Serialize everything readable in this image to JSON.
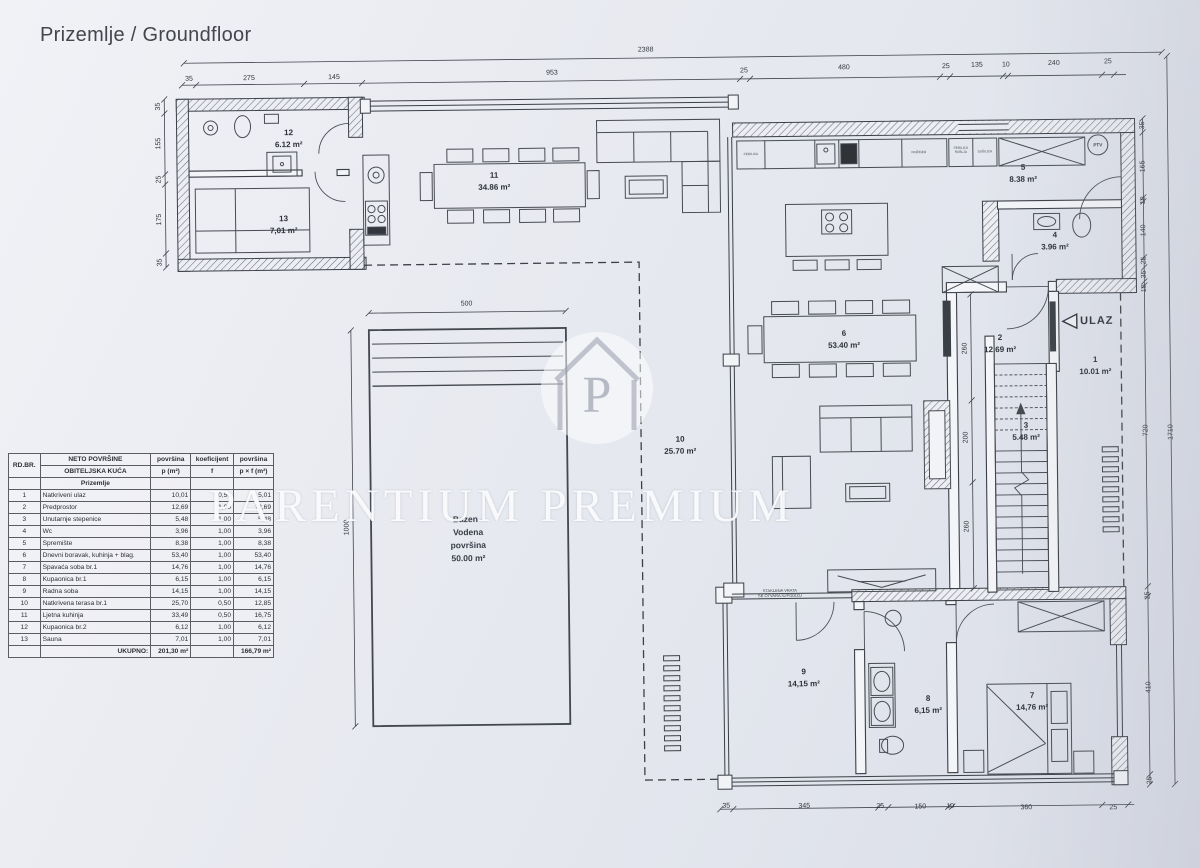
{
  "title": "Prizemlje / Groundfloor",
  "colors": {
    "paper": "#e7e9ef",
    "line": "#3b3f46",
    "watermark": "#ffffff"
  },
  "watermark": {
    "text": "PARENTIUM PREMIUM",
    "monogram": "P"
  },
  "table": {
    "corner": "RD.BR.",
    "h1": "NETO POVRŠINE",
    "h2": "OBITELJSKA KUĆA",
    "c1a": "površina",
    "c1b": "p (m²)",
    "c2a": "koeficijent",
    "c2b": "f",
    "c3a": "površina",
    "c3b": "p × f (m²)",
    "section": "Prizemlje",
    "rows": [
      [
        "1",
        "Natkriveni ulaz",
        "10,01",
        "0,50",
        "5,01"
      ],
      [
        "2",
        "Predprostor",
        "12,69",
        "1,00",
        "12,69"
      ],
      [
        "3",
        "Unutarnje stepenice",
        "5,48",
        "1,00",
        "5,48"
      ],
      [
        "4",
        "Wc",
        "3,96",
        "1,00",
        "3,96"
      ],
      [
        "5",
        "Spremište",
        "8,38",
        "1,00",
        "8,38"
      ],
      [
        "6",
        "Dnevni boravak, kuhinja + blag.",
        "53,40",
        "1,00",
        "53,40"
      ],
      [
        "7",
        "Spavaća soba br.1",
        "14,76",
        "1,00",
        "14,76"
      ],
      [
        "8",
        "Kupaonica br.1",
        "6,15",
        "1,00",
        "6,15"
      ],
      [
        "9",
        "Radna soba",
        "14,15",
        "1,00",
        "14,15"
      ],
      [
        "10",
        "Natkrivena terasa br.1",
        "25,70",
        "0,50",
        "12,85"
      ],
      [
        "11",
        "Ljetna kuhinja",
        "33,49",
        "0,50",
        "16,75"
      ],
      [
        "12",
        "Kupaonica br.2",
        "6,12",
        "1,00",
        "6,12"
      ],
      [
        "13",
        "Sauna",
        "7,01",
        "1,00",
        "7,01"
      ]
    ],
    "total_label": "UKUPNO:",
    "total_p": "201,30 m²",
    "total_pf": "166,79 m²"
  },
  "plan": {
    "rooms": [
      {
        "t": "12\n6.12 m²",
        "x": 292,
        "y": 135
      },
      {
        "t": "13\n7,01 m²",
        "x": 286,
        "y": 221
      },
      {
        "t": "11\n34.86 m²",
        "x": 497,
        "y": 180
      },
      {
        "t": "5\n8.38 m²",
        "x": 1026,
        "y": 178
      },
      {
        "t": "4\n3.96 m²",
        "x": 1057,
        "y": 246
      },
      {
        "t": "6\n53.40 m²",
        "x": 845,
        "y": 342
      },
      {
        "t": "2\n12.69 m²",
        "x": 1001,
        "y": 348
      },
      {
        "t": "1\n10.01 m²",
        "x": 1096,
        "y": 371
      },
      {
        "t": "3\n5.48 m²",
        "x": 1026,
        "y": 436
      },
      {
        "t": "10\n25.70 m²",
        "x": 680,
        "y": 446
      },
      {
        "t": "9\n14,15 m²",
        "x": 801,
        "y": 680
      },
      {
        "t": "8\n6,15 m²",
        "x": 925,
        "y": 708
      },
      {
        "t": "7\n14,76 m²",
        "x": 1029,
        "y": 706
      }
    ],
    "dims": [
      {
        "t": "2388",
        "x": 650,
        "y": 50
      },
      {
        "t": "35",
        "x": 193,
        "y": 74
      },
      {
        "t": "275",
        "x": 253,
        "y": 74
      },
      {
        "t": "145",
        "x": 338,
        "y": 74
      },
      {
        "t": "953",
        "x": 556,
        "y": 72
      },
      {
        "t": "25",
        "x": 748,
        "y": 72
      },
      {
        "t": "480",
        "x": 848,
        "y": 70
      },
      {
        "t": "25",
        "x": 950,
        "y": 70
      },
      {
        "t": "135",
        "x": 981,
        "y": 69
      },
      {
        "t": "10",
        "x": 1010,
        "y": 69
      },
      {
        "t": "240",
        "x": 1058,
        "y": 68
      },
      {
        "t": "25",
        "x": 1112,
        "y": 67
      },
      {
        "t": "35",
        "x": 162,
        "y": 101,
        "r": 1
      },
      {
        "t": "155",
        "x": 162,
        "y": 138,
        "r": 1
      },
      {
        "t": "25",
        "x": 162,
        "y": 174,
        "r": 1
      },
      {
        "t": "175",
        "x": 162,
        "y": 214,
        "r": 1
      },
      {
        "t": "35",
        "x": 162,
        "y": 257,
        "r": 1
      },
      {
        "t": "35",
        "x": 1146,
        "y": 131,
        "r": 1
      },
      {
        "t": "165",
        "x": 1146,
        "y": 172,
        "r": 1
      },
      {
        "t": "10",
        "x": 1146,
        "y": 206,
        "r": 1
      },
      {
        "t": "140",
        "x": 1146,
        "y": 236,
        "r": 1
      },
      {
        "t": "25",
        "x": 1146,
        "y": 266,
        "r": 1
      },
      {
        "t": "35",
        "x": 1146,
        "y": 280,
        "r": 1
      },
      {
        "t": "10",
        "x": 1146,
        "y": 294,
        "r": 1
      },
      {
        "t": "720",
        "x": 1146,
        "y": 436,
        "r": 1
      },
      {
        "t": "25",
        "x": 1146,
        "y": 601,
        "r": 1
      },
      {
        "t": "410",
        "x": 1146,
        "y": 693,
        "r": 1
      },
      {
        "t": "25",
        "x": 1146,
        "y": 786,
        "r": 1
      },
      {
        "t": "1710",
        "x": 1171,
        "y": 438,
        "r": 1
      },
      {
        "t": "35",
        "x": 722,
        "y": 807
      },
      {
        "t": "345",
        "x": 800,
        "y": 808
      },
      {
        "t": "25",
        "x": 876,
        "y": 809
      },
      {
        "t": "150",
        "x": 916,
        "y": 810
      },
      {
        "t": "10",
        "x": 946,
        "y": 810
      },
      {
        "t": "360",
        "x": 1022,
        "y": 812
      },
      {
        "t": "25",
        "x": 1109,
        "y": 813
      },
      {
        "t": "260",
        "x": 966,
        "y": 352,
        "r": 1
      },
      {
        "t": "200",
        "x": 966,
        "y": 441,
        "r": 1
      },
      {
        "t": "260",
        "x": 966,
        "y": 530,
        "r": 1
      },
      {
        "t": "500",
        "x": 468,
        "y": 302
      },
      {
        "t": "1000",
        "x": 346,
        "y": 524,
        "r": 1
      }
    ],
    "notes": [
      {
        "t": "Bazen -\nVodena\npovršina\n50.00 m²",
        "x": 467,
        "y": 537,
        "c": "pool"
      },
      {
        "t": "STAKLENA VRATA\nSE OTVARAJU/PODIŽU",
        "x": 778,
        "y": 595,
        "c": "tiny"
      },
      {
        "t": "ULAZ",
        "x": 1098,
        "y": 326,
        "c": "ulaz"
      },
      {
        "t": "PTV",
        "x": 1101,
        "y": 150,
        "c": "ptv"
      },
      {
        "t": "PERILICA",
        "x": 754,
        "y": 156,
        "c": "appl"
      },
      {
        "t": "FRIŽIDER",
        "x": 922,
        "y": 156,
        "c": "appl"
      },
      {
        "t": "PERILICA\nRUBLJA",
        "x": 964,
        "y": 154,
        "c": "appl"
      },
      {
        "t": "SUŠILICA",
        "x": 988,
        "y": 156,
        "c": "appl"
      }
    ]
  }
}
